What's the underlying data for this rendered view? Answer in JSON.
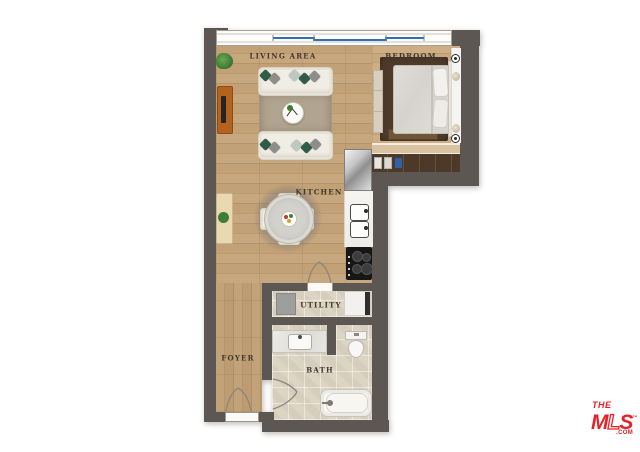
{
  "rooms": {
    "living": "LIVING AREA",
    "bedroom": "BEDROOM",
    "kitchen": "KITCHEN",
    "utility": "UTILITY",
    "foyer": "FOYER",
    "bath": "BATH"
  },
  "logo": {
    "the": "THE",
    "m": "M",
    "l": "L",
    "s": "S",
    "tm": "™",
    "com": ".COM"
  },
  "colors": {
    "wall": "#5c5753",
    "wood_floor": "#c2a176",
    "bedroom_floor": "#c8a87f",
    "tile_floor": "#ddd5c4",
    "window_glass": "#2e6fb5",
    "wardrobe": "#4d3929",
    "bedroom_rug": "#4e3a2a",
    "living_rug": "#b1a591",
    "plant_green": "#4c8b3f",
    "console_orange": "#b4631f",
    "logo_red": "#e32127"
  },
  "furniture": [
    "sofa",
    "sofa",
    "coffee-table",
    "living-rug",
    "tv-console",
    "side-table",
    "plants",
    "dining-table",
    "dining-chairs",
    "refrigerator",
    "kitchen-sink",
    "cooktop",
    "bed",
    "headboard",
    "media-unit",
    "shelf",
    "wall-sconces",
    "wardrobe-closet",
    "washer",
    "storage-unit",
    "bathroom-vanity",
    "toilet",
    "bathtub"
  ]
}
